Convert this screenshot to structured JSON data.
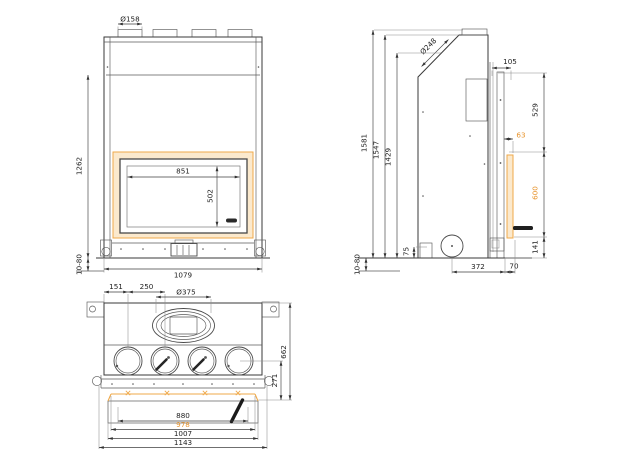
{
  "drawing": {
    "type": "technical-drawing",
    "subject": "fireplace-insert-three-view-dimension-drawing",
    "accent_line_color": "#EFA94A",
    "accent_text_color": "#E8952F",
    "line_color": "#3a3a3a",
    "glass_frame_fill": "#FBE9CD"
  },
  "front": {
    "flue_collar_diameter": "Ø158",
    "frame_height": "1262",
    "glass_width": "851",
    "glass_height": "502",
    "body_width": "1079",
    "leveling_range": "10-80"
  },
  "side": {
    "flue_diameter": "Ø248",
    "total_height": "1581",
    "height_2": "1547",
    "height_3": "1429",
    "top_depth": "105",
    "upper_height": "529",
    "glass_offset": "63",
    "glass_height": "600",
    "base_height": "141",
    "inlet_depth": "372",
    "front_depth": "70",
    "foot_height": "75",
    "leveling_range": "10-80"
  },
  "bottom": {
    "edge_to_port": "151",
    "port_spacing": "250",
    "flue_oval": "Ø375",
    "total_depth": "662",
    "front_depth": "271",
    "opening_width": "880",
    "glass_width": "978",
    "frame_width": "1007",
    "total_width": "1143"
  }
}
